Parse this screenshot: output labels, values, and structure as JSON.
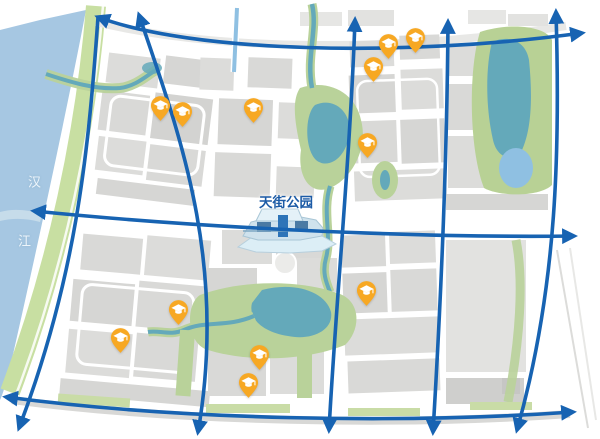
{
  "map": {
    "labels": {
      "park": {
        "text": "天街公园",
        "x": 286,
        "y": 201
      },
      "river_chars": [
        {
          "text": "汉",
          "x": 35,
          "y": 181
        },
        {
          "text": "江",
          "x": 25,
          "y": 240
        }
      ]
    },
    "school_pins": [
      {
        "x": 160,
        "y": 105
      },
      {
        "x": 182,
        "y": 111
      },
      {
        "x": 253,
        "y": 107
      },
      {
        "x": 373,
        "y": 66
      },
      {
        "x": 388,
        "y": 43
      },
      {
        "x": 415,
        "y": 37
      },
      {
        "x": 367,
        "y": 142
      },
      {
        "x": 178,
        "y": 309
      },
      {
        "x": 120,
        "y": 337
      },
      {
        "x": 259,
        "y": 354
      },
      {
        "x": 248,
        "y": 382
      },
      {
        "x": 366,
        "y": 290
      }
    ],
    "colors": {
      "grid_blue": "#1763b2",
      "pin_orange": "#F7A823",
      "cap_white": "#ffffff",
      "river_blue": "#a6c7e2",
      "bank_green": "#c8dfa2",
      "park_green": "#b9d29a",
      "water_teal": "#64a9ba",
      "pond_blue": "#8fc0e2",
      "block_gray": "#d9d9d7",
      "label_blue": "#1c5ba6"
    }
  }
}
